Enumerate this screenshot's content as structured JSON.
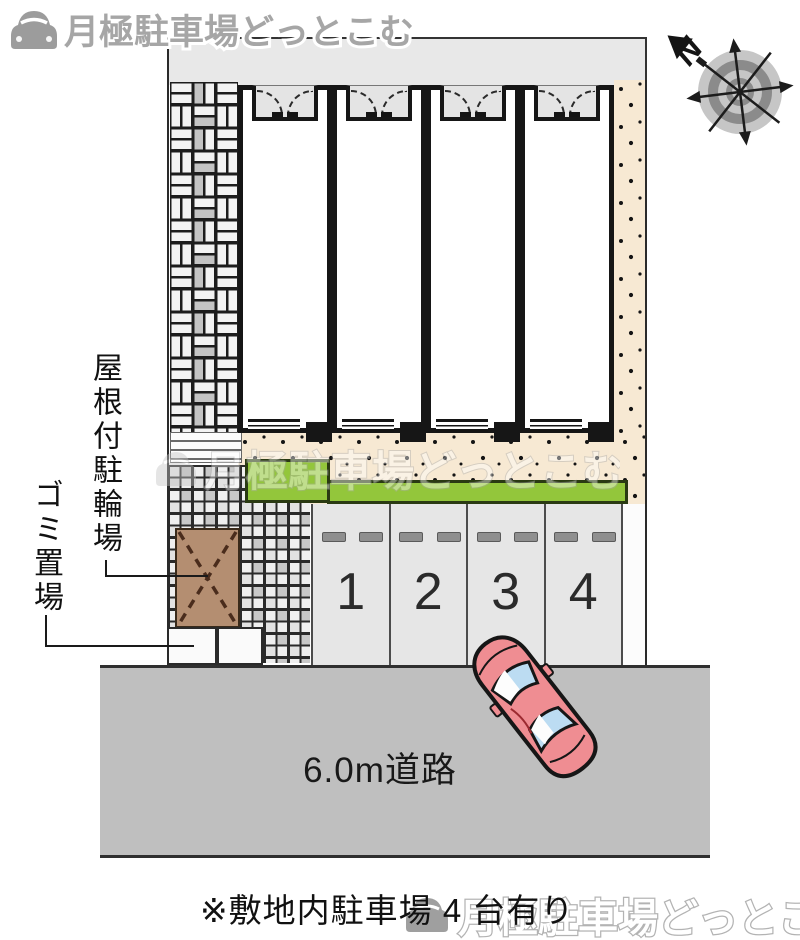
{
  "brand": {
    "logo_text": "月極駐車場どっとこむ"
  },
  "compass": {
    "north_label": "N"
  },
  "plan": {
    "bicycle_label": "屋根付駐輪場",
    "garbage_label": "ゴミ置場",
    "road_label": "6.0m道路",
    "spaces": [
      "1",
      "2",
      "3",
      "4"
    ]
  },
  "caption": "※敷地内駐車場 4 台有り",
  "watermarks": {
    "center": "月極駐車場どっとこむ",
    "bottom": "月極駐車場どっとこむ"
  },
  "colors": {
    "grass": "#93c63b",
    "beige": "#f7e9d3",
    "road": "#bfbfbf",
    "car_body": "#ef8d92",
    "car_window": "#bcdcf2",
    "roof_brown": "#b48e71",
    "top_strip": "#e8e8e8",
    "parking": "#e6e6e6"
  }
}
